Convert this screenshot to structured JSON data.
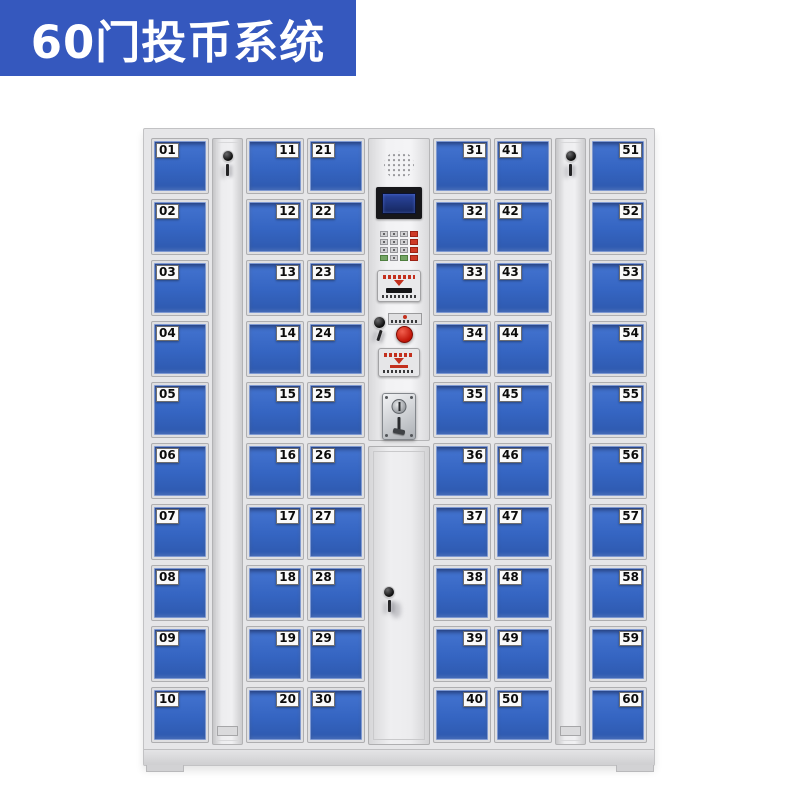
{
  "banner": {
    "title": "60门投币系统"
  },
  "colors": {
    "banner_blue": "#3558BE",
    "door_blue": "#3565C2",
    "accent_red": "#C6281A",
    "screen_blue": "#27418F"
  },
  "doors": {
    "col1": [
      "01",
      "02",
      "03",
      "04",
      "05",
      "06",
      "07",
      "08",
      "09",
      "10"
    ],
    "col2": [
      "11",
      "12",
      "13",
      "14",
      "15",
      "16",
      "17",
      "18",
      "19",
      "20"
    ],
    "col3": [
      "21",
      "22",
      "23",
      "24",
      "25",
      "26",
      "27",
      "28",
      "29",
      "30"
    ],
    "col4": [
      "31",
      "32",
      "33",
      "34",
      "35",
      "36",
      "37",
      "38",
      "39",
      "40"
    ],
    "col5": [
      "41",
      "42",
      "43",
      "44",
      "45",
      "46",
      "47",
      "48",
      "49",
      "50"
    ],
    "col6": [
      "51",
      "52",
      "53",
      "54",
      "55",
      "56",
      "57",
      "58",
      "59",
      "60"
    ]
  },
  "control_panel": {
    "components": [
      "speaker",
      "lcd-display",
      "keypad",
      "card-reader",
      "key-lock",
      "coin-return-button",
      "instruction-panel",
      "coin-acceptor"
    ]
  }
}
